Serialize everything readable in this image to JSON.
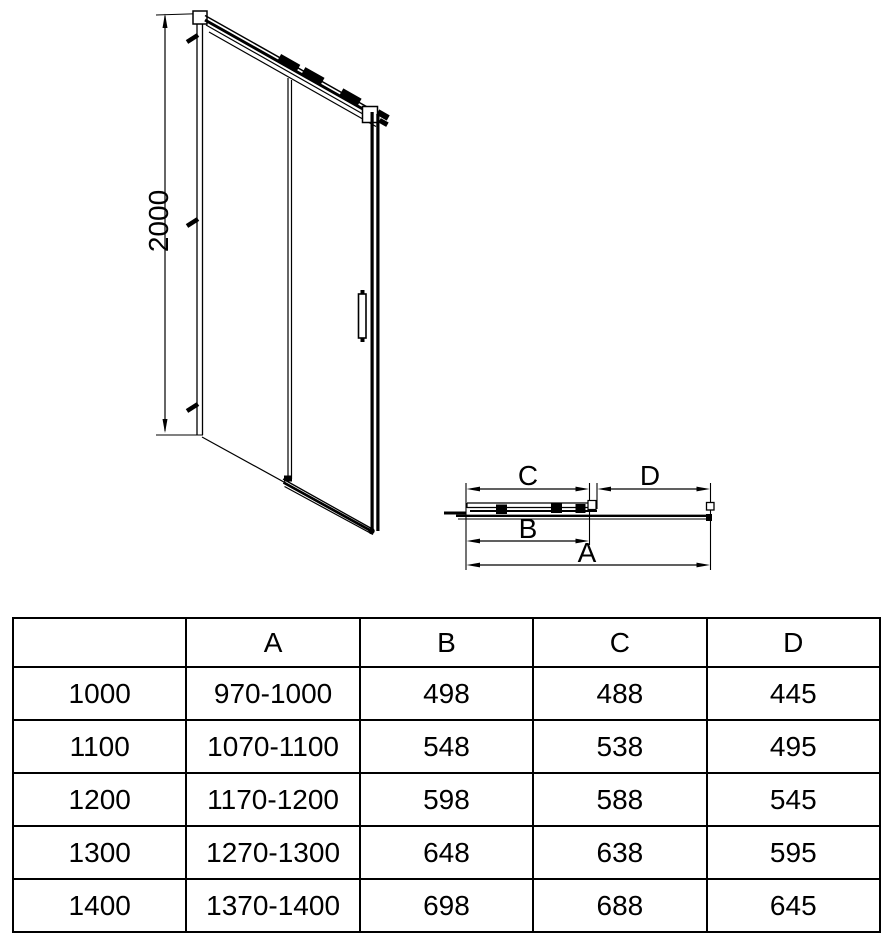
{
  "drawing": {
    "front_view": {
      "height_label": "2000"
    },
    "plan_view": {
      "dim_c_label": "C",
      "dim_d_label": "D",
      "dim_b_label": "B",
      "dim_a_label": "A"
    },
    "line_color": "#000000",
    "background_color": "#ffffff"
  },
  "table": {
    "headers": [
      "",
      "A",
      "B",
      "C",
      "D"
    ],
    "rows": [
      {
        "size": "1000",
        "a": "970-1000",
        "b": "498",
        "c": "488",
        "d": "445"
      },
      {
        "size": "1100",
        "a": "1070-1100",
        "b": "548",
        "c": "538",
        "d": "495"
      },
      {
        "size": "1200",
        "a": "1170-1200",
        "b": "598",
        "c": "588",
        "d": "545"
      },
      {
        "size": "1300",
        "a": "1270-1300",
        "b": "648",
        "c": "638",
        "d": "595"
      },
      {
        "size": "1400",
        "a": "1370-1400",
        "b": "698",
        "c": "688",
        "d": "645"
      }
    ]
  }
}
